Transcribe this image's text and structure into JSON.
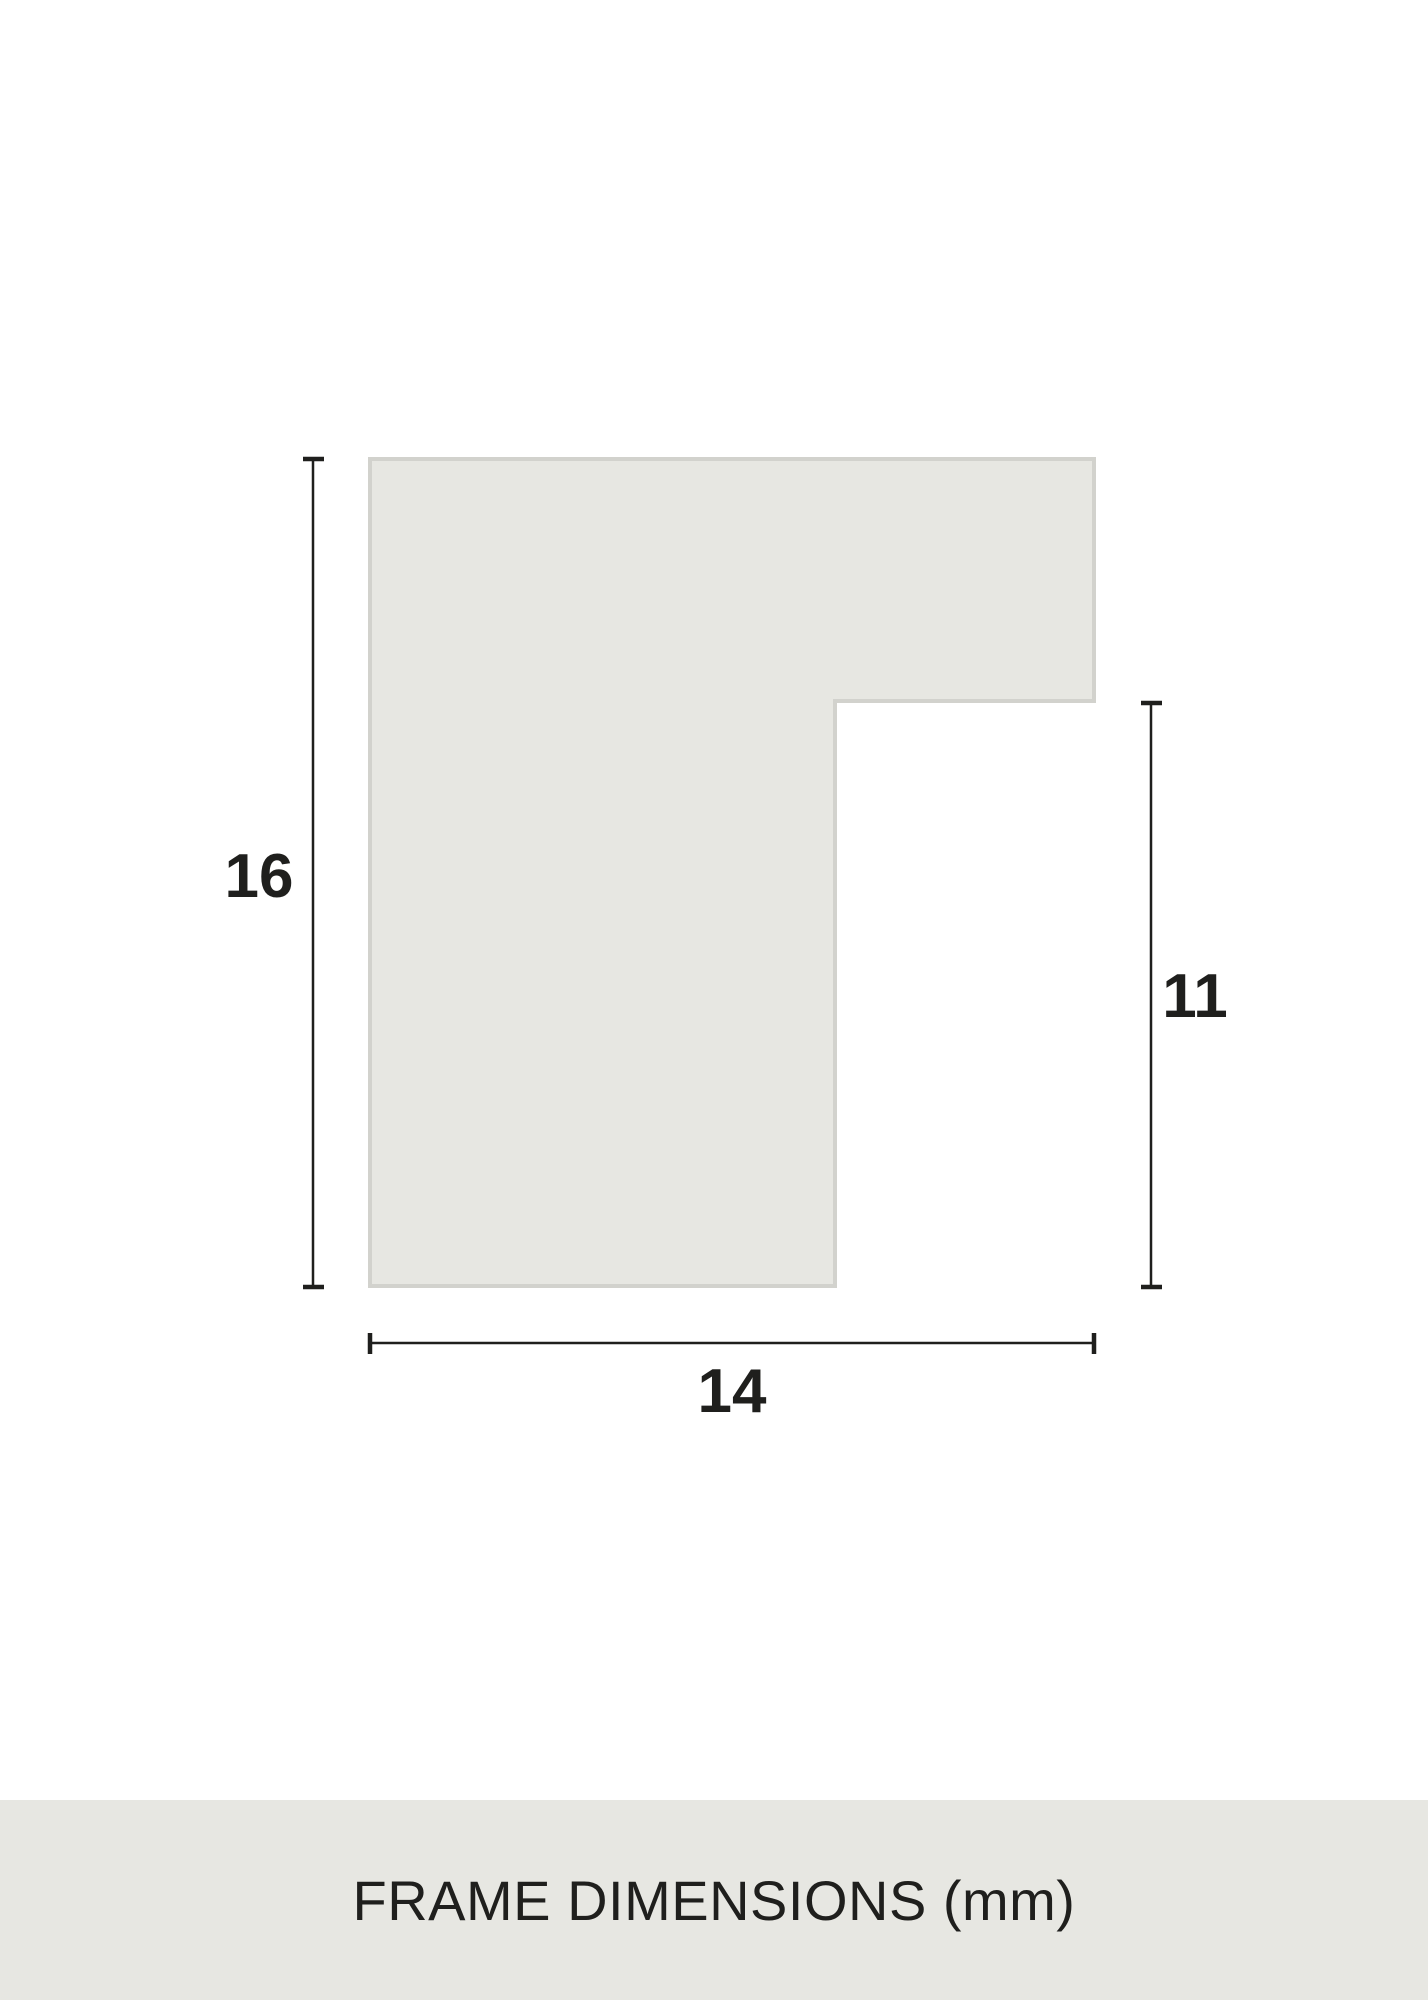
{
  "diagram": {
    "caption": "FRAME DIMENSIONS (mm)",
    "dimensions": {
      "left_height": "16",
      "right_height": "11",
      "bottom_width": "14"
    },
    "colors": {
      "background": "#ffffff",
      "shape_fill": "#e7e7e2",
      "shape_border": "#d2d2cd",
      "dimension_lines": "#1f1f1d",
      "label_text": "#1f1f1d",
      "footer_band": "#e7e7e2",
      "footer_text": "#1f1f1d"
    }
  }
}
